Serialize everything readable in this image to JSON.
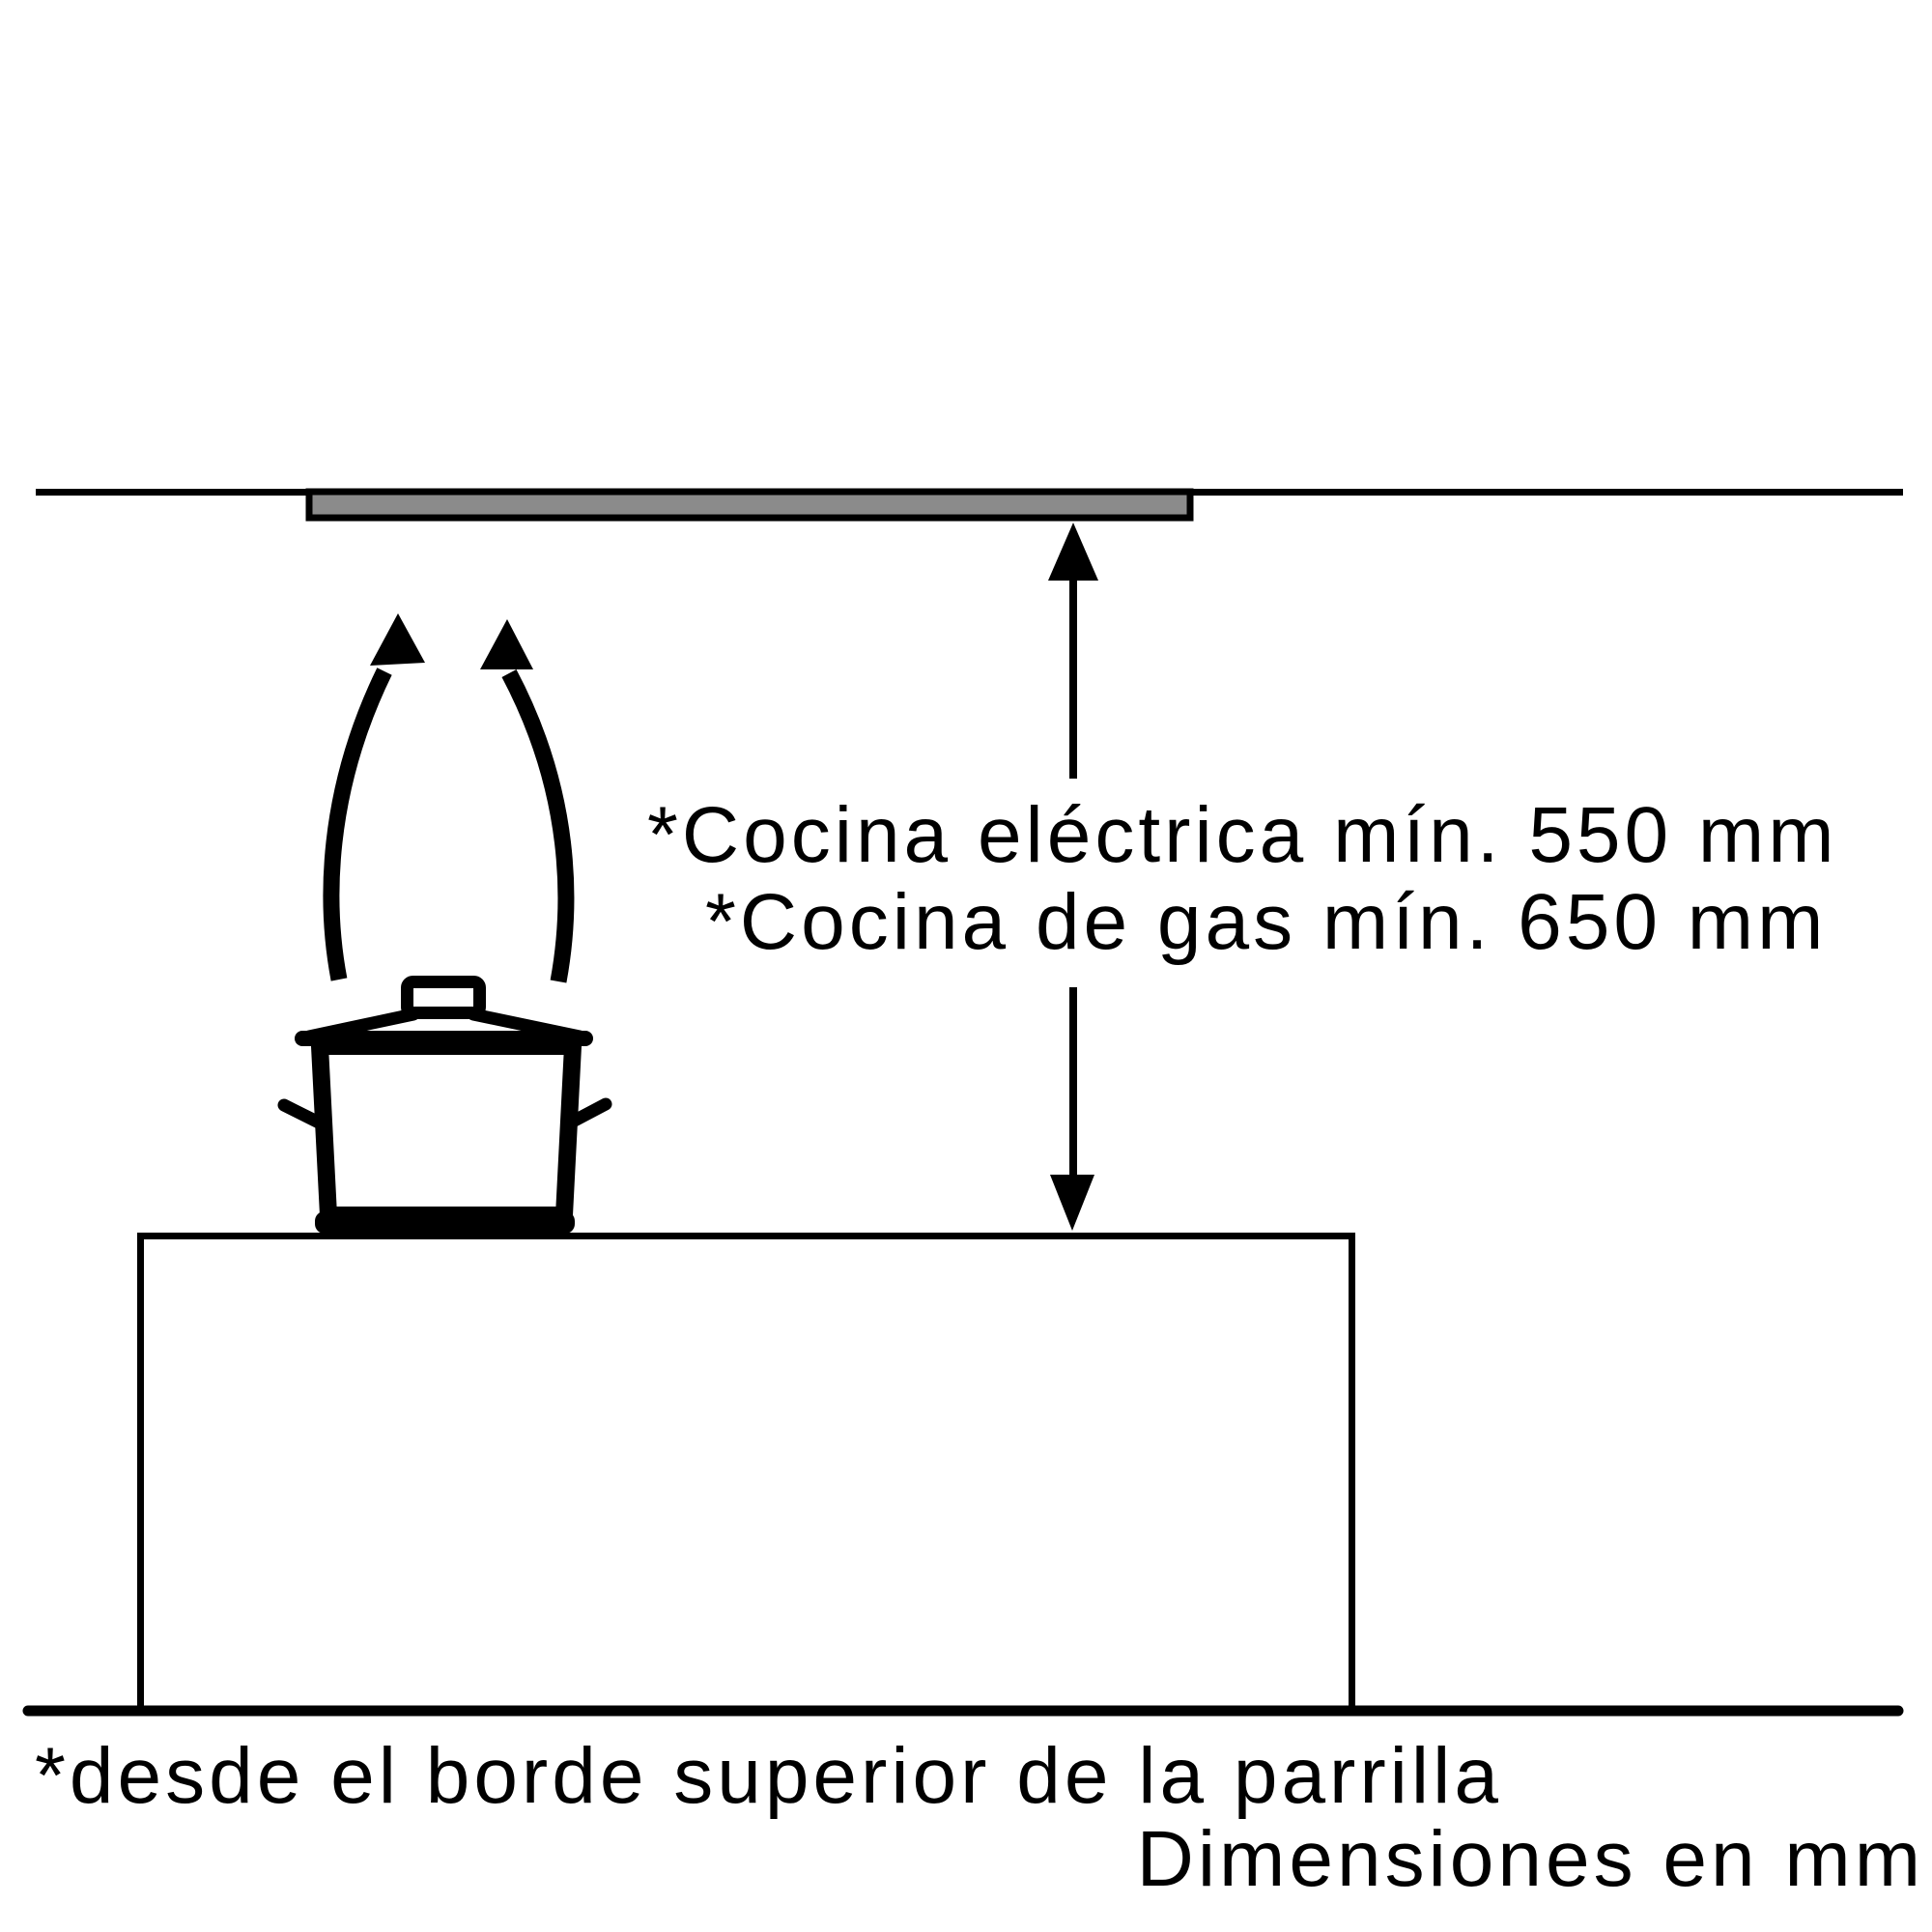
{
  "diagram": {
    "annotations": {
      "electric_min": "*Cocina eléctrica mín. 550 mm",
      "gas_min": "*Cocina de gas mín. 650 mm",
      "footnote": "*desde el borde superior de la parrilla",
      "units_note": "Dimensiones en mm"
    },
    "values": {
      "electric_min_mm": 550,
      "gas_min_mm": 650
    },
    "colors": {
      "ink": "#000000",
      "hood_fill": "#8b8b8b",
      "background": "#ffffff"
    },
    "icons": [
      "ceiling-line",
      "extractor-hood",
      "steam-arrow-left",
      "steam-arrow-right",
      "cooking-pot",
      "dimension-arrow",
      "worktop",
      "floor-line"
    ]
  }
}
